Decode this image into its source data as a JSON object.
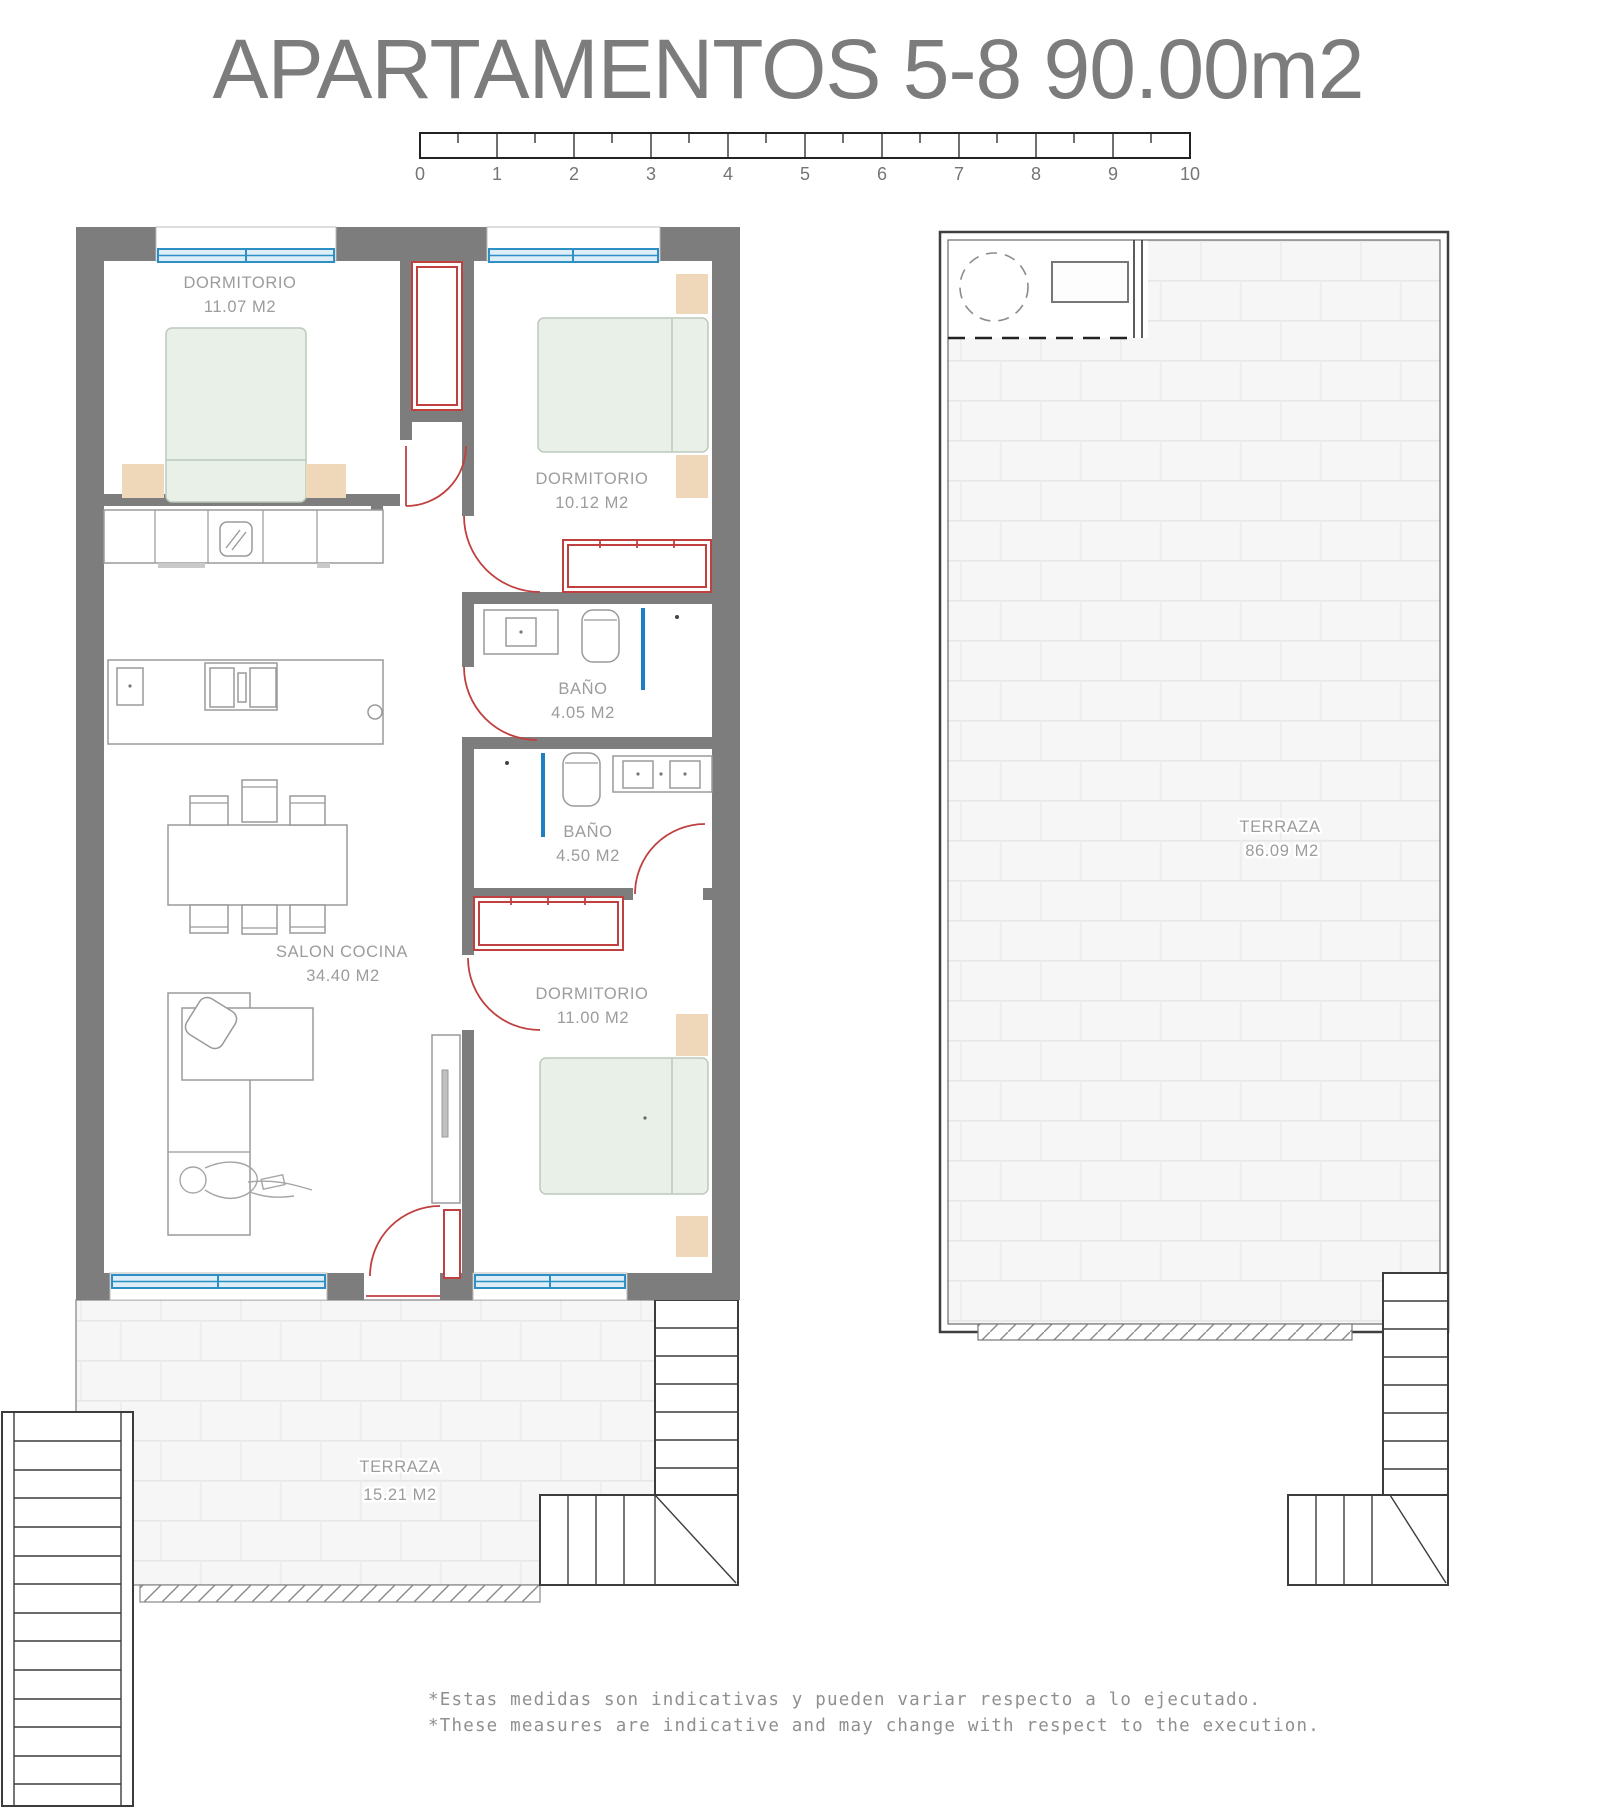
{
  "page": {
    "title": "APARTAMENTOS 5-8  90.00m2"
  },
  "scale_bar": {
    "labels": [
      "0",
      "1",
      "2",
      "3",
      "4",
      "5",
      "6",
      "7",
      "8",
      "9",
      "10"
    ]
  },
  "rooms": {
    "bedroom1": {
      "name": "DORMITORIO",
      "area": "11.07 M2"
    },
    "bedroom2": {
      "name": "DORMITORIO",
      "area": "10.12 M2"
    },
    "bathroom1": {
      "name": "BAÑO",
      "area": "4.05 M2"
    },
    "bathroom2": {
      "name": "BAÑO",
      "area": "4.50 M2"
    },
    "living": {
      "name": "SALON COCINA",
      "area": "34.40 M2"
    },
    "bedroom3": {
      "name": "DORMITORIO",
      "area": "11.00 M2"
    },
    "terrace_small": {
      "name": "TERRAZA",
      "area": "15.21 M2"
    },
    "terrace_large": {
      "name": "TERRAZA",
      "area": "86.09 M2"
    }
  },
  "notes": {
    "line1": "*Estas medidas son indicativas y pueden variar respecto a lo ejecutado.",
    "line2": "*These measures are indicative and may change with respect to the execution."
  },
  "colors": {
    "wall_gray": "#7d7d7d",
    "window_blue": "#2d8fc4",
    "carpentry_red": "#c04040",
    "bed_green": "#e9f0e8",
    "nightstand_tan": "#efd8ba",
    "label_gray": "#9c9c9c",
    "tile_white": "#f6f6f6"
  }
}
